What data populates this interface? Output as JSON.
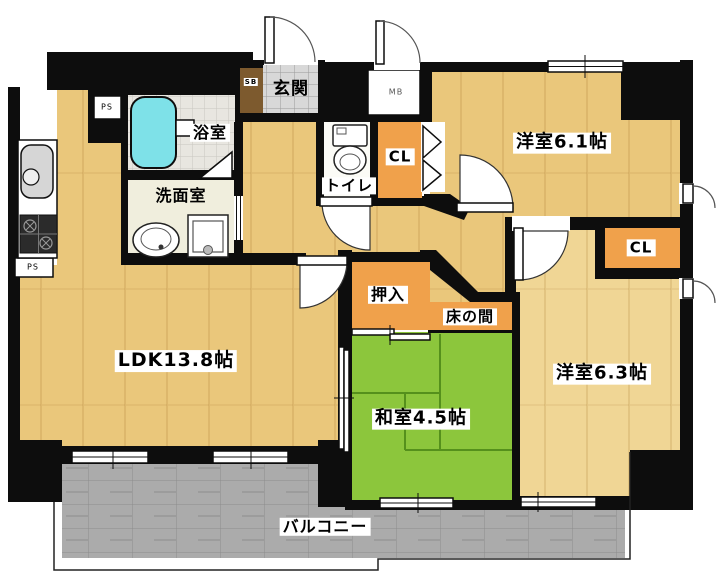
{
  "floorplan": {
    "title": "2LDK apartment floor plan",
    "rooms": {
      "ldk": {
        "label": "LDK13.8帖"
      },
      "washitsu": {
        "label": "和室4.5帖"
      },
      "yoshitsu1": {
        "label": "洋室6.1帖"
      },
      "yoshitsu2": {
        "label": "洋室6.3帖"
      },
      "genkan": {
        "label": "玄関"
      },
      "yokushitsu": {
        "label": "浴室"
      },
      "senmen": {
        "label": "洗面室"
      },
      "toilet": {
        "label": "トイレ"
      },
      "oshiire": {
        "label": "押入"
      },
      "tokonoma": {
        "label": "床の間"
      },
      "balcony": {
        "label": "バルコニー"
      },
      "closet1": {
        "label": "CL"
      },
      "closet2": {
        "label": "CL"
      }
    },
    "utility_labels": {
      "mb": "MB",
      "ps1": "PS",
      "ps2": "PS",
      "sb": "SB"
    },
    "colors": {
      "wall": "#0d0d0d",
      "wood": "#eac77b",
      "wood2": "#f0d695",
      "woodLine": "#b98c46",
      "tatami": "#8cc63c",
      "tatamiLine": "#55901c",
      "closet": "#f0a14b",
      "genkanTile": "#d8d8d8",
      "shoebox": "#7d5a2e",
      "bathTile": "#e8e6e0",
      "tub": "#7ee1e8",
      "washroom": "#f0eedd",
      "toiletFloor": "#fbfbf6",
      "balcony": "#ababab"
    }
  }
}
